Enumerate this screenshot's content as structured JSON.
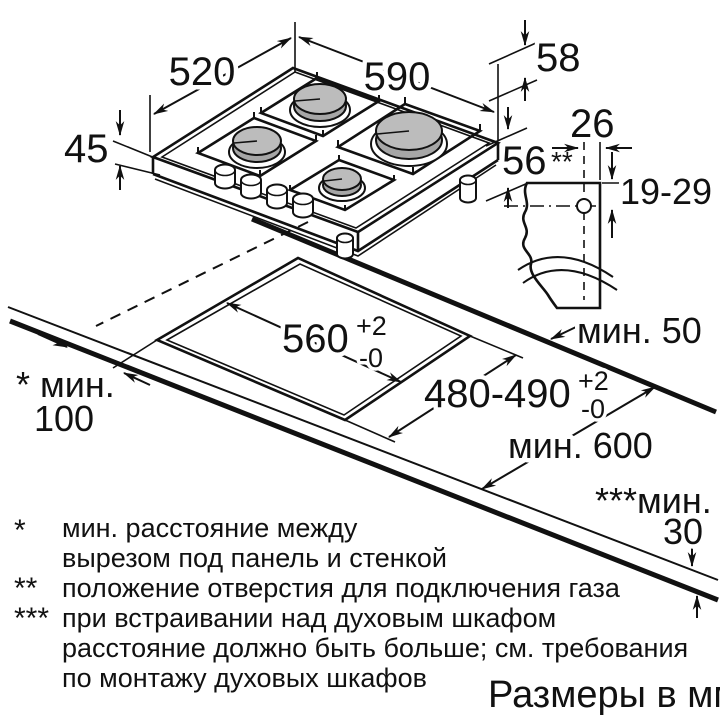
{
  "drawing": {
    "hob": {
      "depth_label": "520",
      "width_label": "590",
      "height_with_supports_label": "58",
      "height_label": "45",
      "depth_below_label": "56"
    },
    "gas_connection": {
      "offset_label": "26",
      "marker": "**",
      "height_range_label": "19-29"
    },
    "cutout": {
      "width_label": "560",
      "width_tol_upper": "+2",
      "width_tol_lower": "-0",
      "depth_label": "480-490",
      "depth_tol_upper": "+2",
      "depth_tol_lower": "-0"
    },
    "clearances": {
      "rear_label": "мин. 50",
      "side_marker_label": "* мин.",
      "side_value_label": "100",
      "front_label": "мин. 600",
      "oven_marker_label": "***мин.",
      "oven_value_label": "30"
    }
  },
  "footnotes": [
    {
      "marker": "*",
      "line1": "мин. расстояние между",
      "line2": "вырезом под панель и стенкой"
    },
    {
      "marker": "**",
      "line1": "положение отверстия для подключения газа"
    },
    {
      "marker": "***",
      "line1": "при встраивании над духовым шкафом",
      "line2": "расстояние должно быть больше; см. требования",
      "line3": "по монтажу духовых шкафов"
    }
  ],
  "units_label": "Размеры в мм"
}
